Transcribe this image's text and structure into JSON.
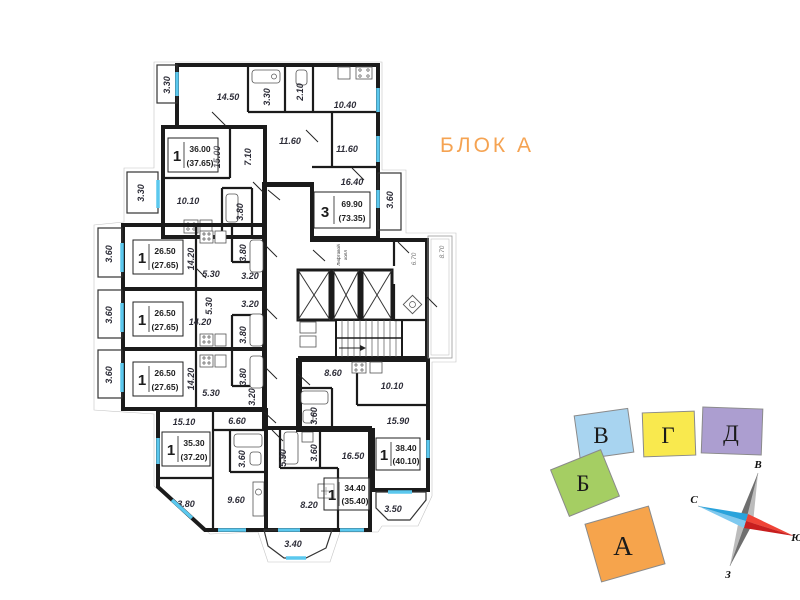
{
  "title": "БЛОК А",
  "palette": {
    "pink": "#F2A6CC",
    "yellow_top": "#FAF2A0",
    "yellow_bottom": "#F8EC62",
    "blue": "#A9D2F0",
    "green": "#A9D176",
    "orange": "#F6A84F",
    "purple": "#B3A5D3",
    "accent": "#F5A352",
    "window": "#5BC8EE",
    "wall": "#1B1B1B"
  },
  "core": {
    "hall_label_line1": "Лифтовой",
    "hall_label_line2": "холл",
    "corridor_dim": "6.70",
    "outer_dim": "8.70"
  },
  "apartments": {
    "pink3": {
      "type": "3",
      "area": "69.90",
      "total": "(73.35)",
      "rooms": {
        "r1": "14.50",
        "bath": "3.30",
        "wc": "2.10",
        "kitchen": "10.40",
        "hall": "11.60",
        "bed": "11.60",
        "living": "16.40",
        "balcony_top": "3.30",
        "balcony_right": "3.60"
      }
    },
    "yellow_top": {
      "type": "1",
      "area": "36.00",
      "total": "(37.65)",
      "rooms": {
        "living": "15.00",
        "hall": "7.10",
        "kitchen": "10.10",
        "bath": "3.80",
        "balcony": "3.30"
      }
    },
    "blue": {
      "type": "1",
      "area": "26.50",
      "total": "(27.65)",
      "rooms": {
        "living": "14.20",
        "kitchen": "5.30",
        "bath": "3.80",
        "hall": "3.20",
        "balcony": "3.60"
      }
    },
    "green_mid": {
      "type": "1",
      "area": "26.50",
      "total": "(27.65)",
      "rooms": {
        "living": "14.20",
        "kitchen": "5.30",
        "bath": "3.80",
        "hall": "3.20",
        "balcony": "3.60"
      }
    },
    "orange": {
      "type": "1",
      "area": "26.50",
      "total": "(27.65)",
      "rooms": {
        "living": "14.20",
        "kitchen": "5.30",
        "bath": "3.80",
        "hall": "3.20",
        "balcony": "3.60"
      }
    },
    "yellow_bottom": {
      "type": "1",
      "area": "35.30",
      "total": "(37.20)",
      "rooms": {
        "living": "15.10",
        "hall": "6.60",
        "bath": "3.60",
        "kitchen": "9.60",
        "balcony": "3.80"
      }
    },
    "purple": {
      "type": "1",
      "area": "34.40",
      "total": "(35.40)",
      "rooms": {
        "hall": "5.90",
        "bath": "3.60",
        "living": "16.50",
        "kitchen": "8.20",
        "balcony": "3.40"
      }
    },
    "green_bottom": {
      "type": "1",
      "area": "38.40",
      "total": "(40.10)",
      "rooms": {
        "kitchen": "8.60",
        "hall": "10.10",
        "living": "15.90",
        "bath": "3.60",
        "balcony": "3.50"
      }
    }
  },
  "minimap": {
    "blocks": [
      {
        "label": "В",
        "color": "#A8D4F0"
      },
      {
        "label": "Г",
        "color": "#F9E94E"
      },
      {
        "label": "Д",
        "color": "#AC9ED0"
      },
      {
        "label": "Б",
        "color": "#A5CE63"
      },
      {
        "label": "А",
        "color": "#F6A44C"
      }
    ]
  },
  "compass": {
    "east": "В",
    "north": "С",
    "south": "Ю",
    "west": "З"
  }
}
